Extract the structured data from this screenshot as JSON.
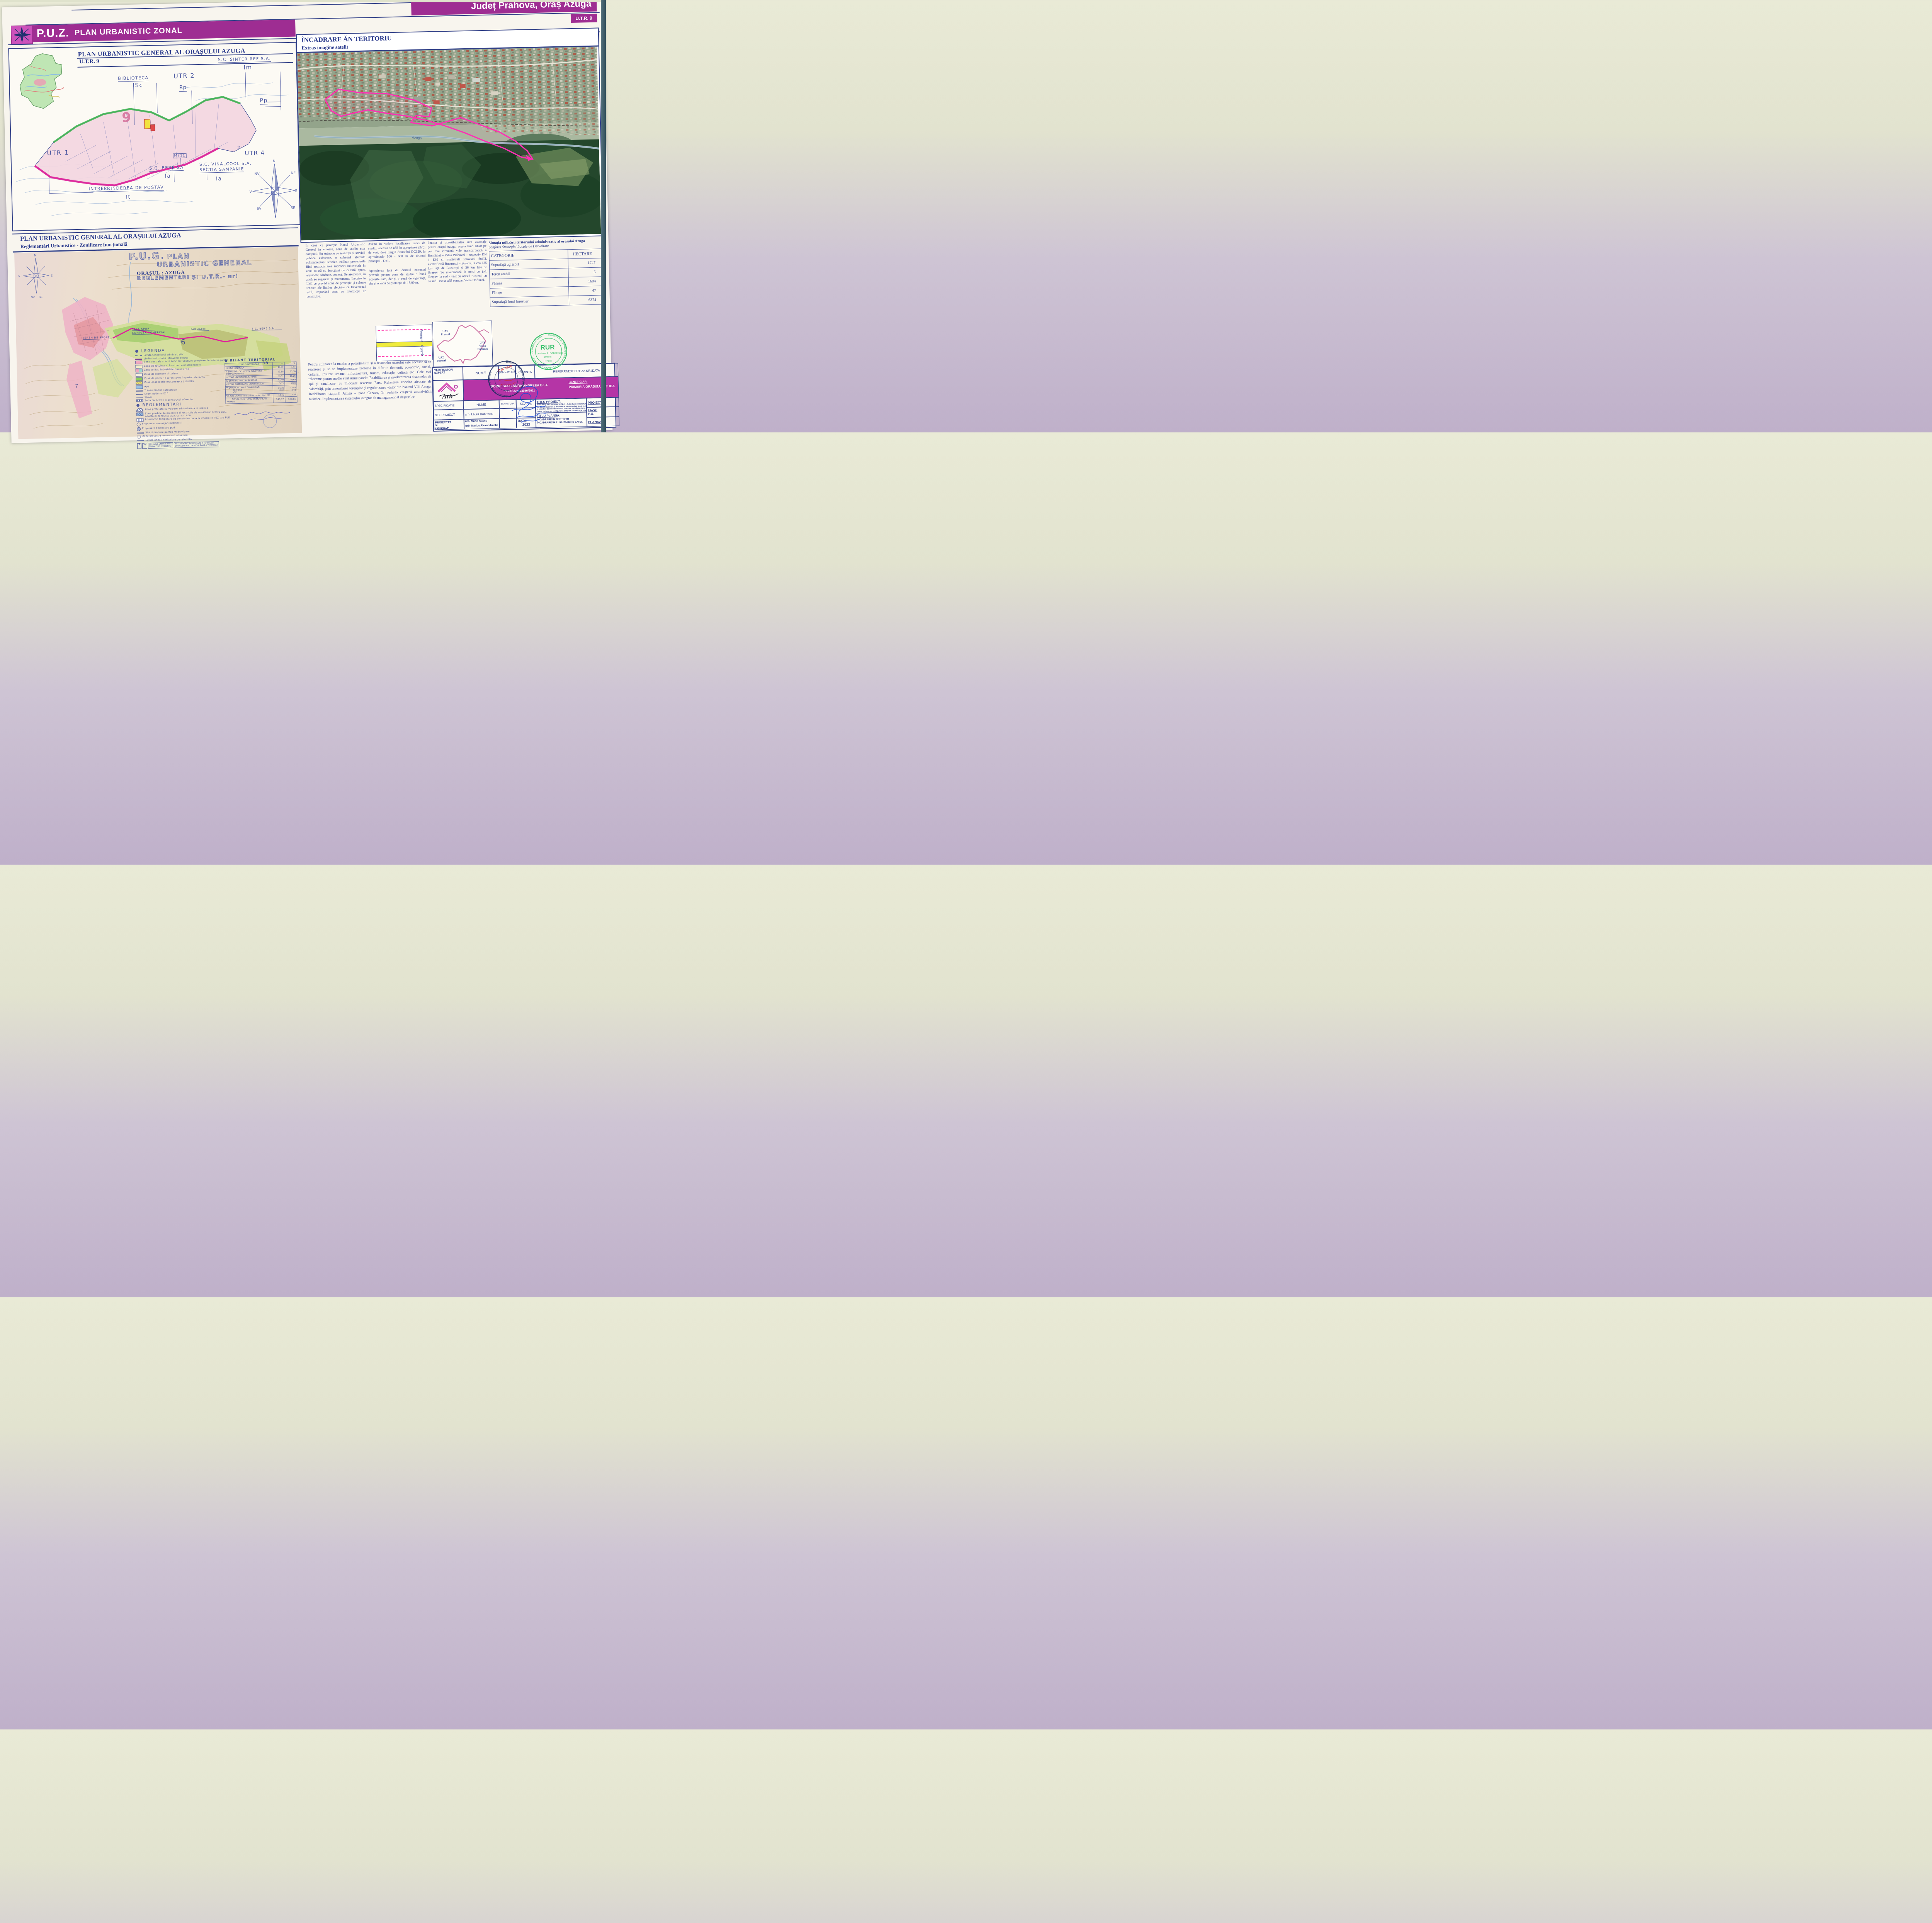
{
  "header": {
    "puz_abbr": "P.U.Z.",
    "puz_title": "PLAN URBANISTIC ZONAL",
    "region": "Județ Prahova, Oraș Azuga",
    "utr": "U.T.R. 9",
    "accent_purple": "#9e2d92"
  },
  "panel_utr9": {
    "title": "PLAN URBANISTIC GENERAL AL ORAȘULUI AZUGA",
    "subtitle": "U.T.R. 9",
    "labels": {
      "utr1": "UTR 1",
      "utr2": "UTR 2",
      "utr4": "UTR 4",
      "biblioteca": "BIBLIOTECA",
      "biblioteca_code": "ISc",
      "pp_a": "Pp",
      "pp_b": "Pp",
      "sinter": "S.C. SINTER REF  S.A.",
      "sinter_code": "Im",
      "m711": "M711",
      "bere": "S.C. BERE SA",
      "bere_code": "Ia",
      "vinalcool_1": "S.C. VINALCOOL S.A.",
      "vinalcool_2": "SECTIA SAMPANIE",
      "vinalcool_code": "Ia",
      "postav": "INTREPRINDEREA DE POSTAV",
      "postav_code": "It",
      "zone_9": "9",
      "zone_2": "2"
    },
    "compass": {
      "n": "N",
      "ne": "NE",
      "e": "E",
      "se": "SE",
      "sv": "SV",
      "v": "V",
      "nv": "NV"
    }
  },
  "panel_satelit": {
    "title": "ÎNCADRARE ĂN TERITORIU",
    "subtitle": "Extras imagine satelit",
    "river_label": "Azuga",
    "boundary_color": "#ff2fb4"
  },
  "panel_pug": {
    "title": "PLAN URBANISTIC GENERAL AL ORAȘULUI AZUGA",
    "subtitle": "Reglementări Urbanistice - Zonificare funcțională",
    "map_title_abbr": "P.U.G.",
    "map_title_1": "PLAN",
    "map_title_2": "URBANISTIC GENERAL",
    "map_title_3": "ORAȘUL : AZUGA",
    "map_title_4": "REGLEMENTARI ȘI U.T.R.- uri",
    "map_labels": {
      "teren_sport": "TEREN DE SPORT",
      "sala_sport": "SALA SPORT",
      "complex": "COMPLEX COMERCIAL",
      "farmacie": "FARMACIE",
      "bere": "S.C. BERE S.A.",
      "z6": "6",
      "z5a": "5a",
      "z7": "7"
    },
    "legend_title": "LEGENDA",
    "legend": [
      {
        "label": "Limita teritoriului administrativ"
      },
      {
        "label": "Limita teritoriului intravilan propus"
      },
      {
        "label": "Zona centrala si alte zone cu functiuni complexe de interes public"
      },
      {
        "label": "Zona de locuinte si functiuni complementare"
      },
      {
        "label": "Zona unitati industriale / ocol silvic"
      },
      {
        "label": "Zona de recreere si turism"
      },
      {
        "label": "Zona de parcuri / teren sport / sporturi de iarna"
      },
      {
        "label": "Zona gospodarie oraseneasca / cimitire"
      },
      {
        "label": "Ape"
      },
      {
        "label": "Traseu propus autostrada"
      },
      {
        "label": "Drum national E15"
      },
      {
        "label": "Strazi"
      },
      {
        "label": "Zona cai ferate si constructii aferente"
      }
    ],
    "reglementari_title": "REGLEMENTARI",
    "reglementari": [
      {
        "label": "Zona protejata cu valoare arhitecturala si istorica"
      },
      {
        "label": "Zona perdele de protectie si restrictie de construire pentru LEA, aductiuni conducte apa, cursuri apa"
      },
      {
        "label": "Interdictie temporara de construire pana la intocmire PUZ sau PUD"
      },
      {
        "label": "Propunere amenajari intersectii"
      },
      {
        "label": "Propunere amenajare pod"
      },
      {
        "label": "Strazi propuse pentru modernizare"
      },
      {
        "label": "Zona protectie monument al naturii"
      },
      {
        "label": "Limita unitati teritoriale de referinta"
      }
    ],
    "ref_box": {
      "num": "7",
      "pct": "%",
      "line1": "NUMARUL UNITATII TERI-",
      "line2": "TORIALE DE REFERINTA",
      "pot1": "POT- PROCENT DE OCUPARE",
      "pot2": "A TERENULUI",
      "cut1": "CUT  COEFICIENT DE UTILI-",
      "cut2": "ZARE A TERENULUI"
    },
    "bilant": {
      "title": "BILANT TERITORIAL",
      "head_zone": "ZONE FUNCTIONALE",
      "head_ha": "ha",
      "head_pct": "%",
      "rows": [
        {
          "z": "I ZONA CENTRALA",
          "ha": "18,50",
          "p": "7,60"
        },
        {
          "z1": "II ZONA DE LOCUINTE SI FUNCTIUNI",
          "z2": "COMPLEMENTARE",
          "ha": "73,58",
          "p": "65,50"
        },
        {
          "z": "III ZONA UNITATI INDUSTRIALE",
          "ha": "39,51",
          "p": "16,25"
        },
        {
          "z": "IV ZONA DE PARCURI SI SPORT",
          "ha": "47,40",
          "p": "19,49"
        },
        {
          "z": "V ZONA GOSPODARIE ORASENEASCA",
          "ha": "5,71",
          "p": "2,35"
        },
        {
          "z1": "VI ZONA CAILOR DE COMUNICATII",
          "z2": "RUTIERE",
          "z3": "C F",
          "ha1": "31,20",
          "ha2": "8,80",
          "p1": "12,83",
          "p2": "3,62"
        },
        {
          "z": "VII ALTE  ZONE ( terenuri neconstr., ape, etc )",
          "ha": "18,50",
          "p": "7,61"
        }
      ],
      "total_1": "TOTAL TERITORIU INTRAVILAN",
      "total_2": "PROPUS",
      "total_ha": "243,20",
      "total_p": "100,00"
    }
  },
  "text": {
    "col1": "În ceea ce privește Planul Urbanistic General în vigoare, zona de studiu este compusă din subzone cu instituții și servicii publice existente, o subzonă aferentă echipamentului tehnico- edilitar, prevederile fiind restructurarea subzonei industriale în zonă mixtă cu funcțiuni de cultură, sport, agrement, sănătate, comerț. De asemenea, în zonă se regăsesc și monumente înscrise în LMI ce prevăd zone de protecție și culoare tehnice ale liniilor electrice ce traversează situl, impunând zone cu interdicție de construire.",
    "col2_p1": "Având în vedere localizarea zonei de studiu, aceasta se află în apropierea părții de vest, de-a lungul drumului DC129, la aproximativ 500 - 600 m de drumul principal - Dn1.",
    "col2_p2": "Apropierea față de drumul comunal prevede pentru zona de studiu o bună accesibilitate, dar și o zonă de siguranță, dar și o zonă de protecție de 18,00 m.",
    "col3": "Poziția și accesibilitatea sunt avantaje pentru orașul Azuga, acesta fiind situat pe cea mai circulată vale transcarpatică a României – Valea Prahovei – respectiv DN 1 E60 și magistrala feroviară dublă, electrificată București – Brașov, la cca 135 km față de București și 36 km față de Brașov. Se învecinează la nord cu jud. Brașov, la sud - vest cu orașul Bușteni, iar la sud - est se află comuna Valea Doftanei.",
    "bottom": "Pentru utilizarea la maxim a potențialului și a resurselor orașului este necesar să se realizeze și să se implementeze proiecte în diferite domenii: economic, social, cultural, resurse umane, infrastructură, turism, educație, cultură etc. Cele mai relevante pentru mediu sunt următoarele: Reabilitarea și modernizarea sistemelor de apă și canalizare, cu înlocuire rezervor Parc. Refacerea zonelor afectate de calamități, prin amenajarea torenților și regularizarea văilor din bazinul Văii Azuga. Reabilitarea stațiunii Azuga – zona Cazacu, în vederea creșterii atractivității turistice. Implementarea sistemului integrat de management al deșeurilor."
  },
  "land_table": {
    "title": "Situația utilizării teritoriului administrativ al orașului Azuga",
    "subtitle": "conform Strategiei Locale de Dezvoltare",
    "head_cat": "CATEGORIE",
    "head_ha": "HECTARE",
    "rows": [
      {
        "cat": "Suprafață agricolă",
        "ha": "1747"
      },
      {
        "cat": "Teren arabil",
        "ha": "6"
      },
      {
        "cat": "Pășuni",
        "ha": "1694"
      },
      {
        "cat": "Fânețe",
        "ha": "47"
      },
      {
        "cat": "Suprafață fond forestier",
        "ha": "6374"
      }
    ]
  },
  "pdiag": {
    "dim_top": "18,00 m",
    "dim_bottom": "18,00 m"
  },
  "udiag": {
    "predeal_1": "UAT",
    "predeal_2": "Predeal",
    "doftanei_1": "UAT",
    "doftanei_2": "Valea",
    "doftanei_3": "Doftanei",
    "busteni_1": "UAT",
    "busteni_2": "Bușteni"
  },
  "stamps": {
    "ring_text": "Birou Individual de Arhitectura • Dobrescu Laura Andreea",
    "tna": "TNA 4349",
    "rur": "RUR",
    "rur_ring": "REGISTRUL URBANISTILOR DIN ROMANIA • CU DREPT DE SEMNATURA",
    "rur_name": "Andreea E. DOBRESCU",
    "rur_role": "arhitect",
    "rur_code": "D20 E"
  },
  "tblock": {
    "verificator": "VERIFICATOR/",
    "expert": "EXPERT",
    "nume1": "NUME",
    "semnatura1": "SEMNATURA",
    "cerinta": "CERINTA",
    "referat": "REFERAT/EXPERTIZA  NR./DATA",
    "logo": "Arh",
    "firm": "DOBRESCU LAURA ANDREEA B.I.A.",
    "cui": "CUI RO29253940/2011",
    "beneficiar_label": "BENEFICIAR:",
    "beneficiar": "PRIMĂRIA ORAȘULUI AZUGA",
    "specificatie": "SPECIFICATIE",
    "nume2": "NUME",
    "semnatura2": "SEMNATURA",
    "scara": "SCARA:",
    "titlu_proiect_label": "TITLU PROIECT:",
    "titlu_proiect_1": "ÎNTOCMIRE PUZ PENTRU U.T.R. 9 - Schimbare utilitate funcțională",
    "titlu_proiect_2": "din zonă industrială și depozite în zonă mixtă de locuințe individuale",
    "titlu_proiect_3": "și colective de mici dimensiuni, funcțiuni complementare, comerț și",
    "titlu_proiect_4": "centru cultural, cu configurarea căilor de comunicație rutieră",
    "sef_proiect": "SEF PROIECT",
    "sef_nume": "arh. Laura Dobrescu",
    "proiectat": "PROIECTAT",
    "si": "ȘI",
    "desenat": "DESENAT",
    "proiectat_nume": "urb. Maria Ivașcu",
    "desenat_nume": "urb. Marius Alexandru Ilie",
    "data_label": "DATA:",
    "data": "2022",
    "titlu_plansa_label": "TITLU PLANSA:",
    "plansa_1": "ÎNCADRARE ÎN TERITORIU",
    "plansa_2": "ÎNCADRARE ÎN P.U.G.  IMAGINE SATELIT",
    "proiect_nr_label": "PROIECT",
    "proiect_nr": "151",
    "faza_label": "FAZA:",
    "faza": "P.U.",
    "plansa_nr_label": "PLANSA",
    "plansa_nr": "1."
  }
}
